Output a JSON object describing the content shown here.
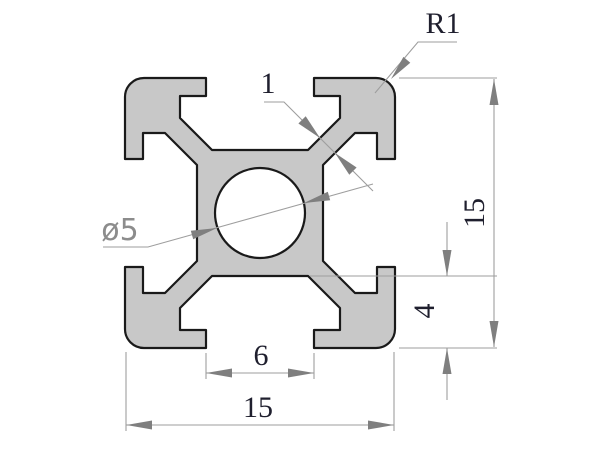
{
  "drawing": {
    "type": "extrusion-profile-cross-section",
    "labels": {
      "corner_radius": "R1",
      "wall_thickness": "1",
      "hole_diameter": "ø5",
      "overall_height": "15",
      "slot_depth": "4",
      "slot_opening_width": "6",
      "overall_width": "15"
    },
    "colors": {
      "background": "#ffffff",
      "profile_fill": "#c8c8c8",
      "outline": "#1a1a1a",
      "dimension_line": "#9e9e9e",
      "arrowhead": "#7f7f7f",
      "dimension_text": "#1f1f2e",
      "diameter_text": "#8c8c8c"
    }
  }
}
